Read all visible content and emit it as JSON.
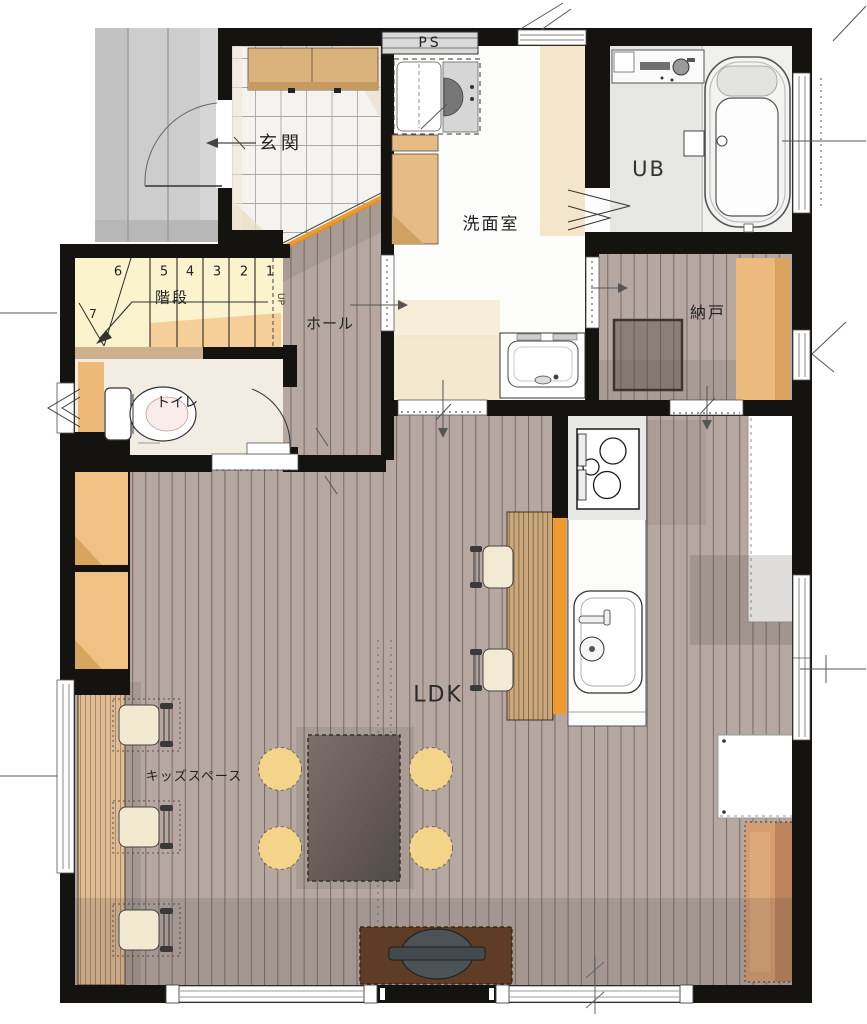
{
  "labels": {
    "entrance": "玄関",
    "pipe_space": "PS",
    "washroom": "洗面室",
    "unit_bath": "UB",
    "stairs": "階段",
    "hall": "ホール",
    "storage": "納戸",
    "toilet": "トイレ",
    "ldk": "LDK",
    "kids_space": "キッズスペース",
    "up": "UP"
  },
  "stairs": {
    "step_numbers": [
      "6",
      "5",
      "4",
      "3",
      "2",
      "1"
    ],
    "winder_step_number": "7"
  },
  "colors": {
    "wall": "#15130f",
    "wood_floor": "#b6a8a1",
    "wood_line": "#6a5d55",
    "entrance_tile": "#f4f3ef",
    "stairs_fill": "#faf3cd",
    "stairs_accent": "#f5cf97",
    "accent_orange": "#ef9b2d",
    "closet_tan": "#f0c183",
    "cushion_yellow": "#f3d489",
    "table_brown": "#5f574f",
    "tv_board_brown": "#5e3c26",
    "porch_gray": "#cbcbcb",
    "mat_orange": "#d69d70",
    "cream": "#f4e6cb",
    "kitchen_white": "#fcfcfb"
  },
  "fixtures": [
    "bathtub",
    "shower-counter",
    "folding-bath-door",
    "washing-machine",
    "laundry-cabinet",
    "shoe-cabinet",
    "vanity-sink",
    "toilet",
    "kitchen-stove",
    "kitchen-sink",
    "bar-counter",
    "bar-chair",
    "dining-table",
    "floor-cushion",
    "tv-board",
    "tv",
    "kids-desk",
    "kids-chair",
    "storage-box",
    "wall-closet",
    "cupboard",
    "entry-door",
    "sliding-door",
    "window"
  ]
}
